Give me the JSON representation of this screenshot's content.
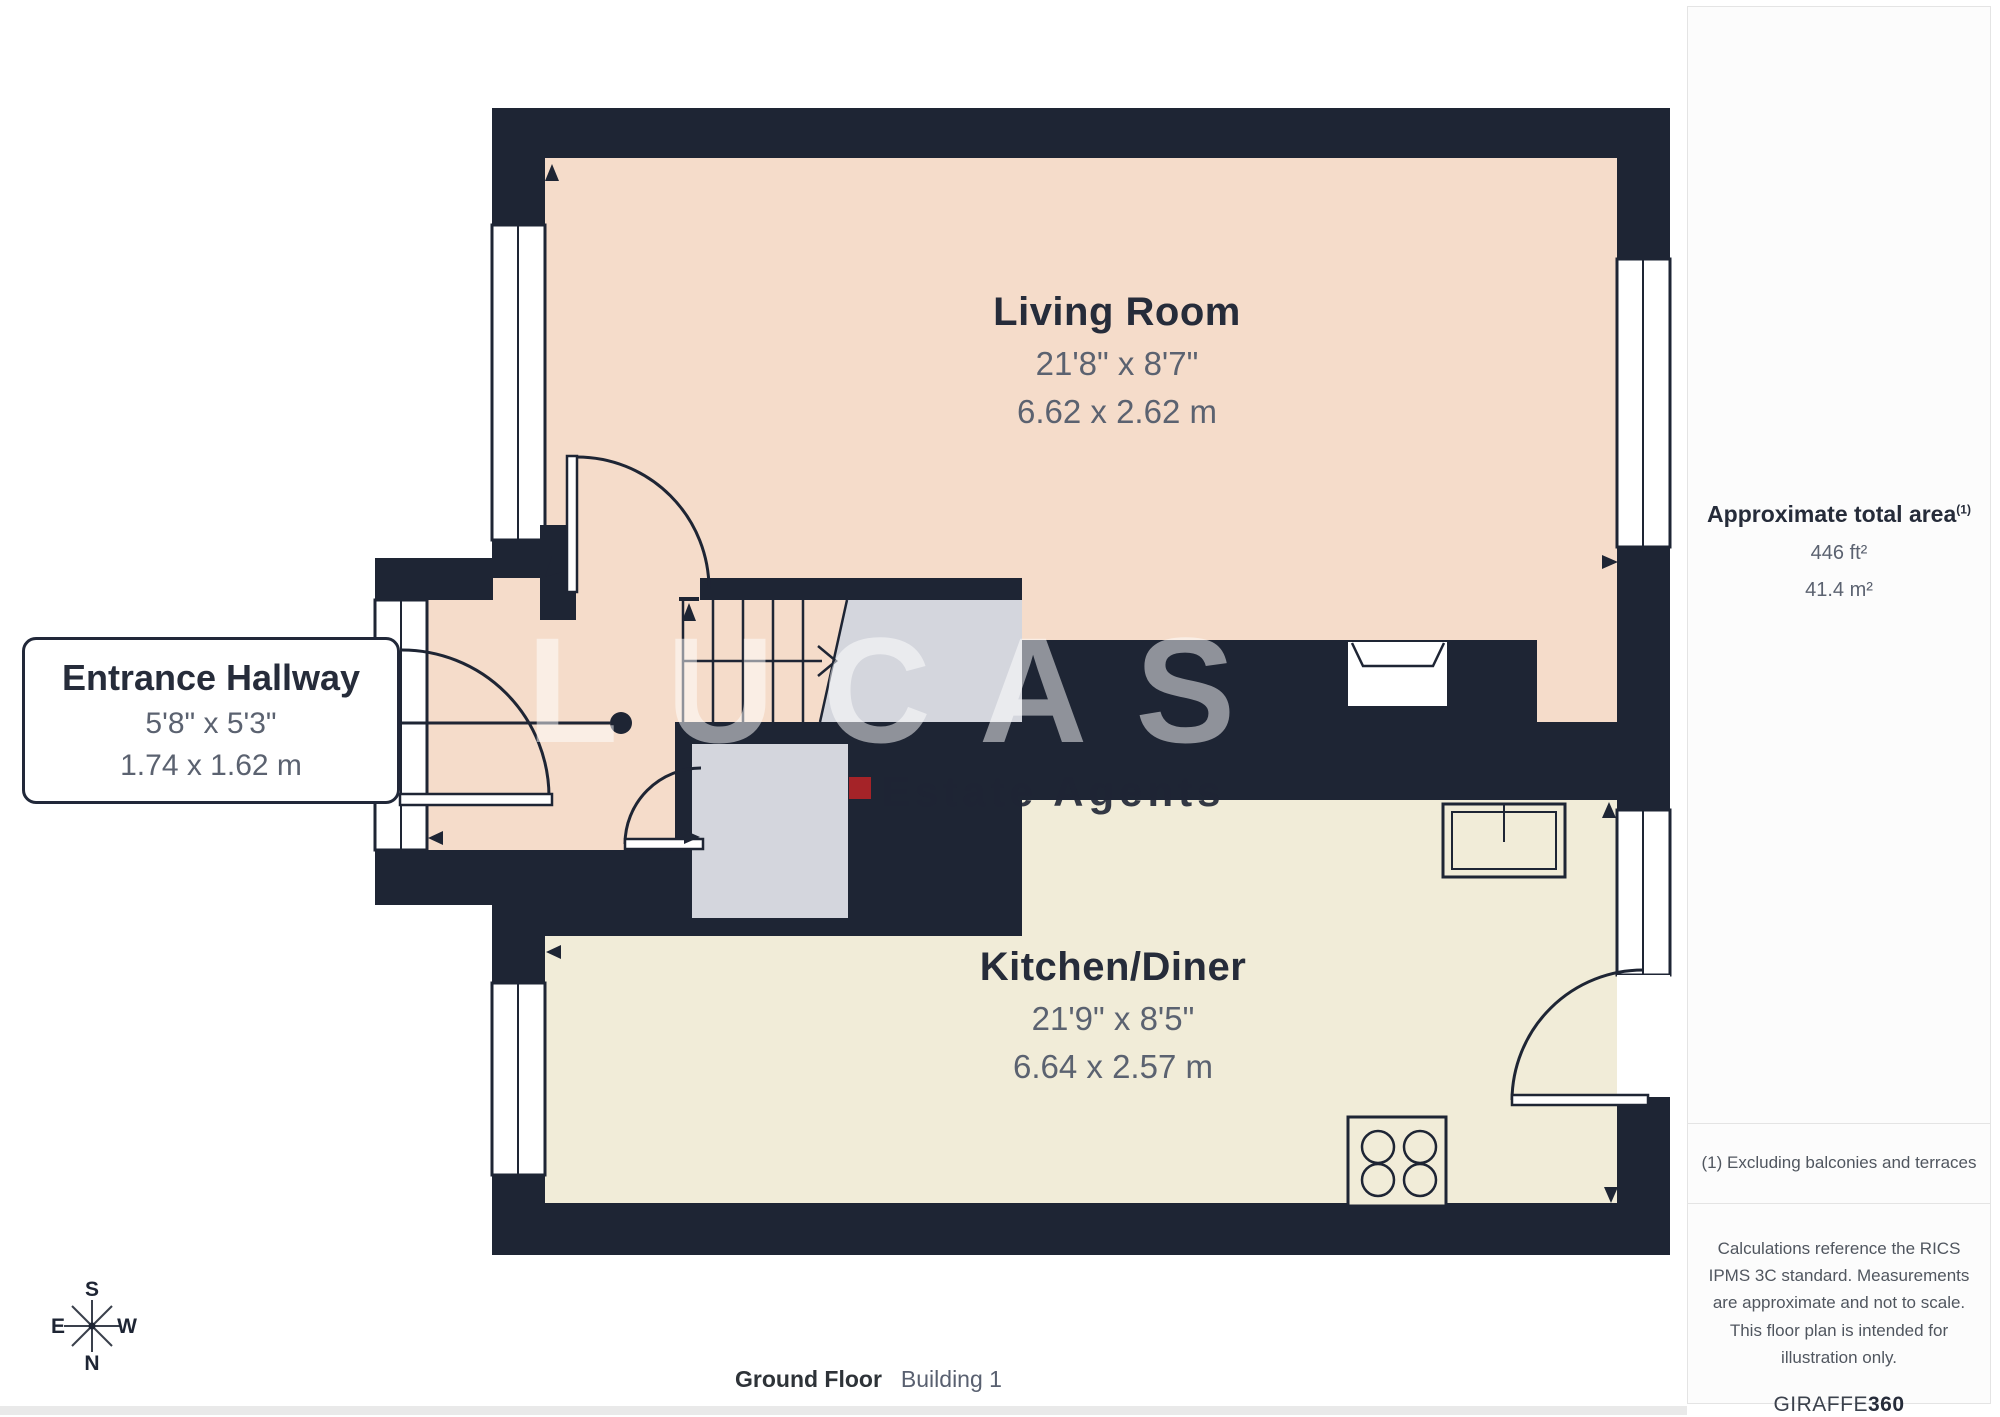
{
  "rooms": {
    "living": {
      "name": "Living Room",
      "imperial": "21'8\" x 8'7\"",
      "metric": "6.62 x 2.62 m"
    },
    "kitchen": {
      "name": "Kitchen/Diner",
      "imperial": "21'9\" x 8'5\"",
      "metric": "6.64 x 2.57 m"
    },
    "hallway": {
      "name": "Entrance Hallway",
      "imperial": "5'8\" x 5'3\"",
      "metric": "1.74 x 1.62 m"
    }
  },
  "sidebar": {
    "area_title": "Approximate total area",
    "area_ref": "(1)",
    "area_imperial": "446 ft²",
    "area_metric": "41.4 m²",
    "footnote": "(1) Excluding balconies and terraces",
    "disclaimer": "Calculations reference the RICS IPMS 3C standard. Measurements are approximate and not to scale. This floor plan is intended for illustration only.",
    "brand_prefix": "GIRAFFE",
    "brand_suffix": "360"
  },
  "footer": {
    "floor": "Ground Floor",
    "building": "Building 1"
  },
  "watermark": {
    "brand": "LUCAS",
    "tagline": "Estate Agents"
  },
  "compass": {
    "north": "N",
    "south": "S",
    "east": "E",
    "west": "W"
  },
  "colors": {
    "wall": "#1e2534",
    "living_floor": "#f5dcca",
    "kitchen_floor": "#f1ecd8",
    "stairs_gray": "#d4d6dd",
    "watermark_red": "#ad2328",
    "sidebar_bg": "#fcfcfc",
    "divider": "#e4e4e4"
  }
}
